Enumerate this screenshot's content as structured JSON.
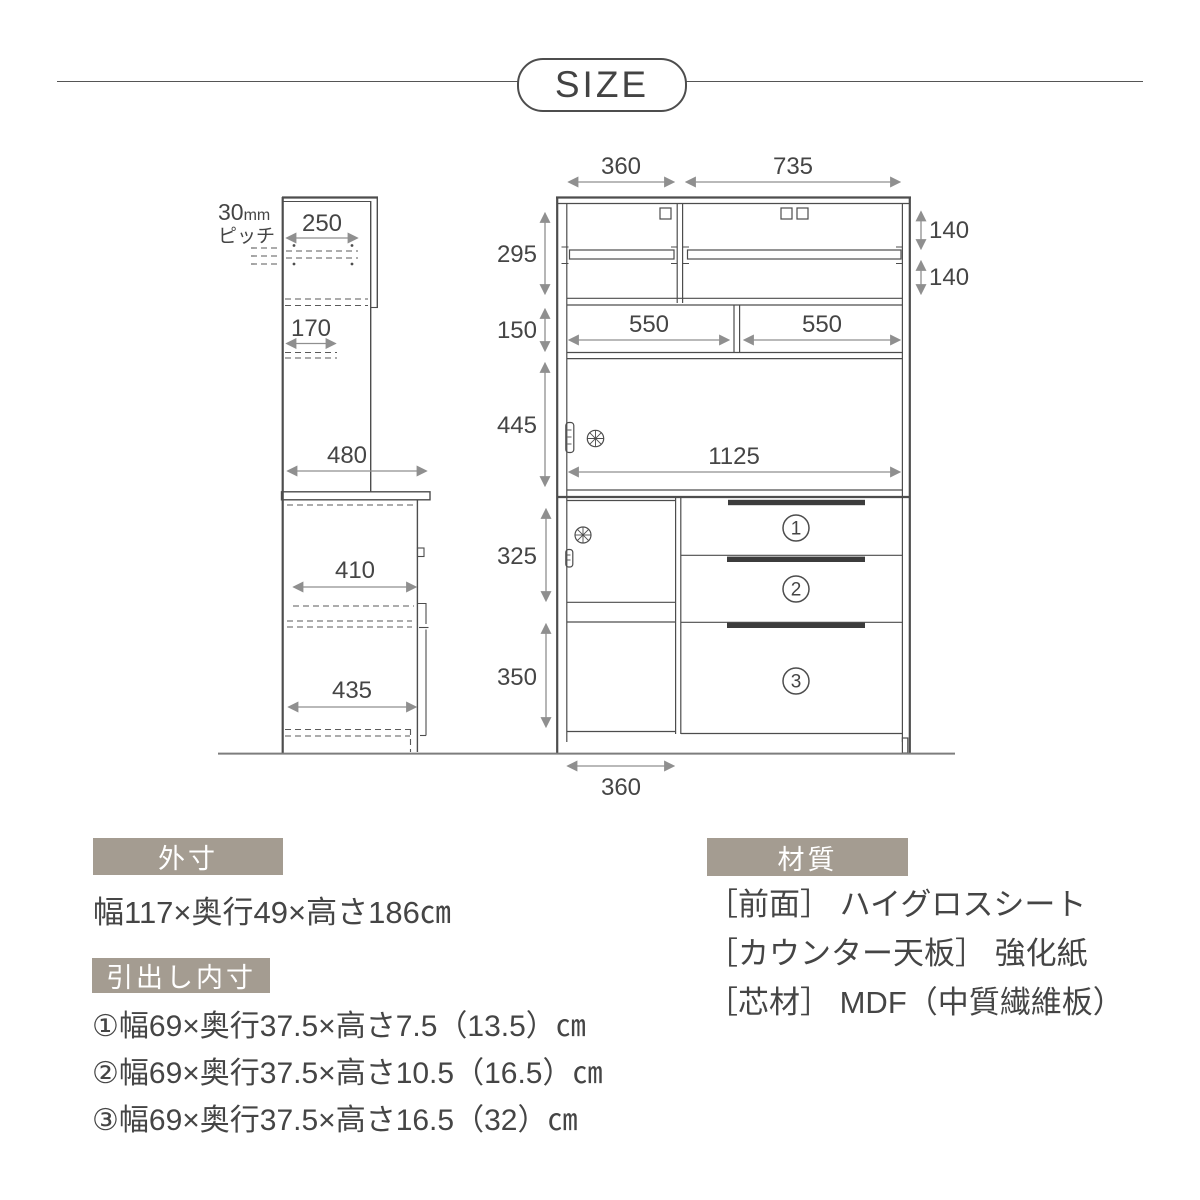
{
  "title": {
    "label": "SIZE"
  },
  "colors": {
    "outline": "#4d4d4d",
    "dimension": "#8f8f8f",
    "text": "#454545",
    "header_bg": "#a49c91",
    "header_text": "#ffffff",
    "handle_bar": "#3c3c3c"
  },
  "side_view": {
    "pitch_num": "30",
    "pitch_unit": "mm",
    "pitch_label": "ピッチ",
    "dims": {
      "shelf_width": "250",
      "hook_depth": "170",
      "total_depth": "480",
      "inner_depth": "410",
      "base_depth": "435"
    }
  },
  "front_view": {
    "dims": {
      "top_left_width": "360",
      "top_right_width": "735",
      "upper_height": "295",
      "shelf_gap_top": "140",
      "shelf_gap_bottom": "140",
      "counter_space_height": "150",
      "counter_left_width": "550",
      "counter_right_width": "550",
      "slide_door_height": "445",
      "slide_door_width": "1125",
      "base_upper_height": "325",
      "base_lower_height": "350",
      "bottom_left_width": "360"
    },
    "drawer_labels": [
      "1",
      "2",
      "3"
    ]
  },
  "sections": {
    "outer": {
      "header": "外寸",
      "body": "幅117×奥行49×高さ186㎝"
    },
    "drawers": {
      "header": "引出し内寸",
      "items": [
        "①幅69×奥行37.5×高さ7.5（13.5）㎝",
        "②幅69×奥行37.5×高さ10.5（16.5）㎝",
        "③幅69×奥行37.5×高さ16.5（32）㎝"
      ]
    },
    "material": {
      "header": "材質",
      "items": [
        "［前面］ ハイグロスシート",
        "［カウンター天板］ 強化紙",
        "［芯材］ MDF（中質繊維板）"
      ]
    }
  }
}
